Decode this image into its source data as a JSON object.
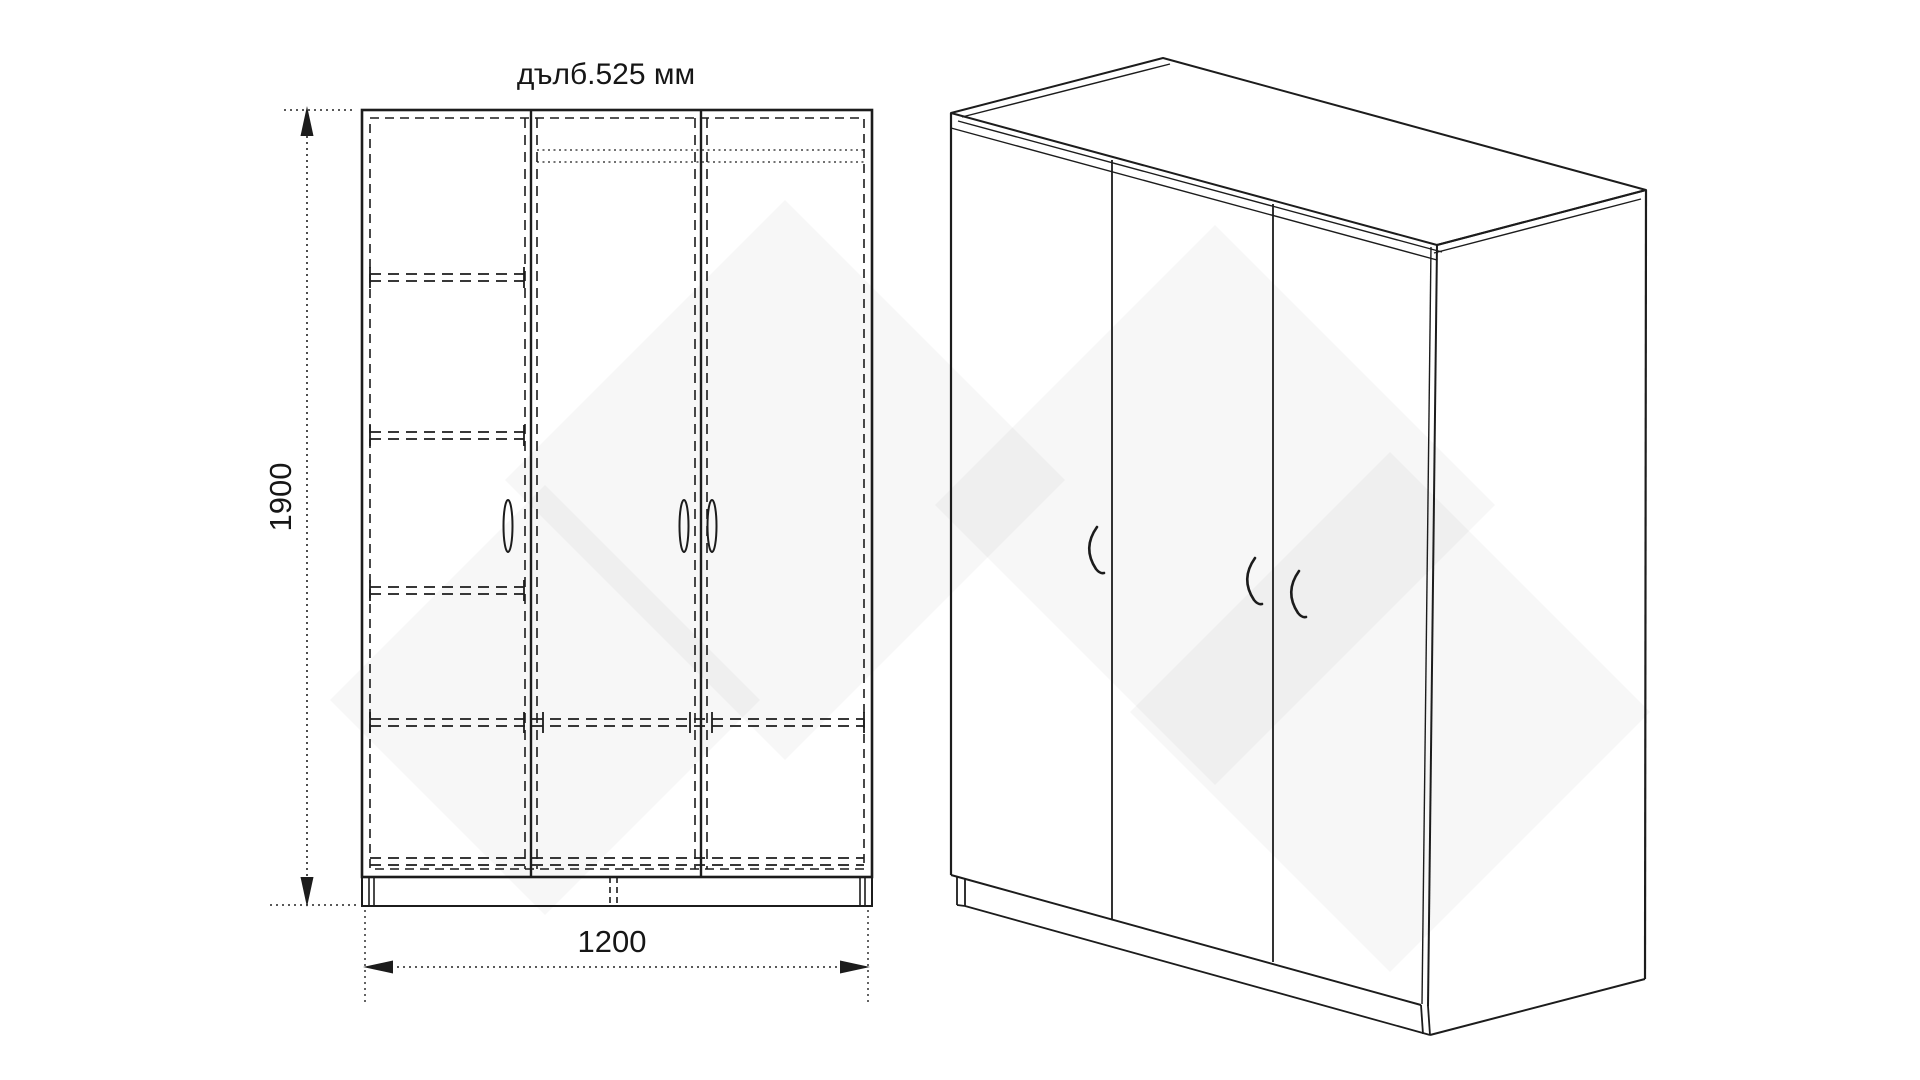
{
  "drawing": {
    "title_label": "дълб.525 мм",
    "front_view": {
      "height_dim_label": "1900",
      "width_dim_label": "1200",
      "door_count": 3,
      "left_column_shelf_count": 3
    },
    "iso_view": {
      "door_count": 3,
      "handle_count": 3
    },
    "colors": {
      "line": "#1c1c1c",
      "text": "#161616",
      "watermark": "#ededed",
      "background": "#ffffff"
    }
  }
}
